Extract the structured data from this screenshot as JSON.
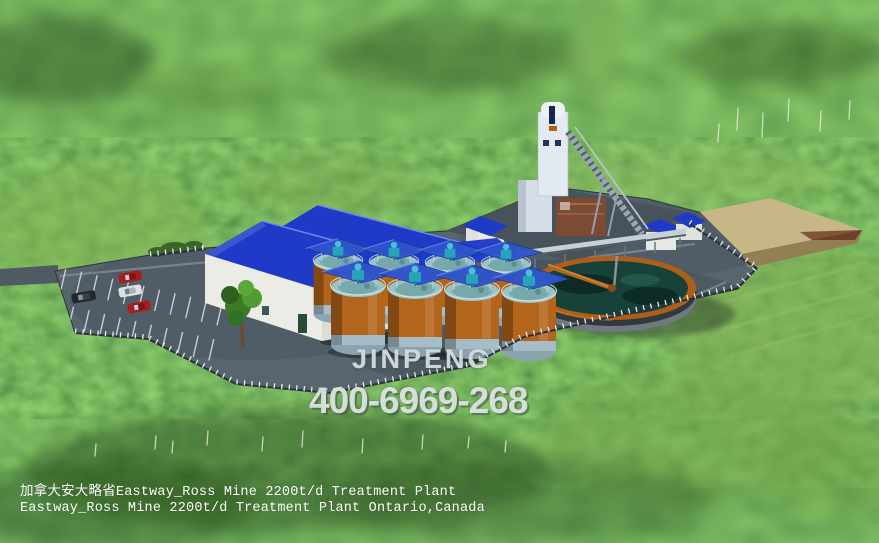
{
  "watermark": {
    "brand": "JINPENG",
    "phone": "400-6969-268"
  },
  "caption": {
    "line1": "加拿大安大略省Eastway_Ross Mine 2200t/d Treatment Plant",
    "line2": "Eastway_Ross Mine 2200t/d Treatment Plant Ontario,Canada"
  },
  "colors": {
    "roof_blue": "#1e3ac6",
    "building_white": "#ecece6",
    "building_white_shaded": "#deddd4",
    "tank_orange": "#b4651c",
    "tank_band_steel": "#a6bcc6",
    "canopy_blue": "#2e54cc",
    "agitator_teal": "#27a4b8",
    "thickener_rim_orange": "#ad5f1a",
    "thickener_water_teal": "#16423a",
    "platform_gray": "#57656e",
    "headframe_pad_gray": "#47525a",
    "stockpile_tan": "#c7b686",
    "forest_green": "#4f7c31",
    "car_red": "#a81e1e",
    "car_white": "#dde2e4",
    "car_black": "#23282e",
    "caption_white": "#ffffff",
    "watermark_gray": "#d6dde0"
  }
}
